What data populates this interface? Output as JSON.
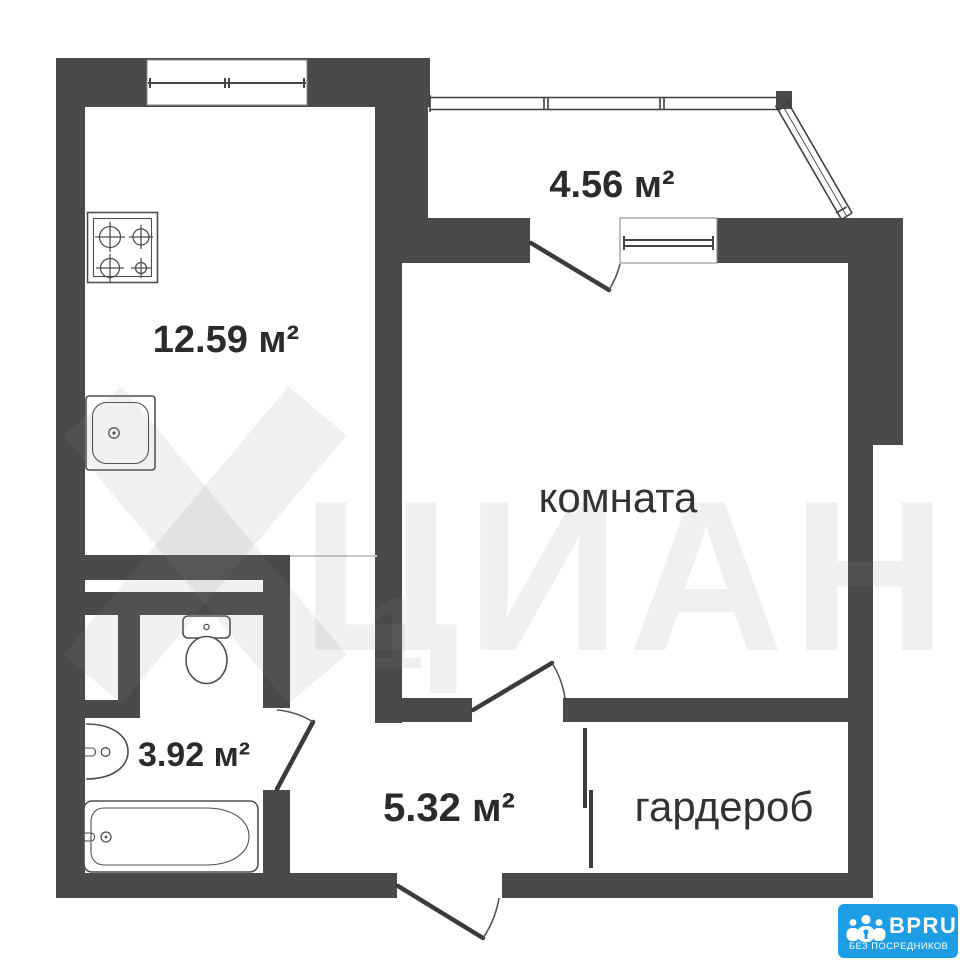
{
  "rooms": {
    "kitchen": {
      "label": "12.59 м²"
    },
    "balcony": {
      "label": "4.56 м²"
    },
    "living_room": {
      "label": "комната"
    },
    "bathroom": {
      "label": "3.92 м²"
    },
    "hallway": {
      "label": "5.32 м²"
    },
    "wardrobe": {
      "label": "гардероб"
    }
  },
  "watermark": {
    "text": "ЦИАН",
    "digit": "1"
  },
  "logo": {
    "name": "BPRU",
    "tagline": "БЕЗ ПОСРЕДНИКОВ",
    "background": "#1c9de4"
  },
  "colors": {
    "wall": "#4a4a4a",
    "label_text": "#2b2b2b",
    "logo_blue": "#1c9de4"
  }
}
